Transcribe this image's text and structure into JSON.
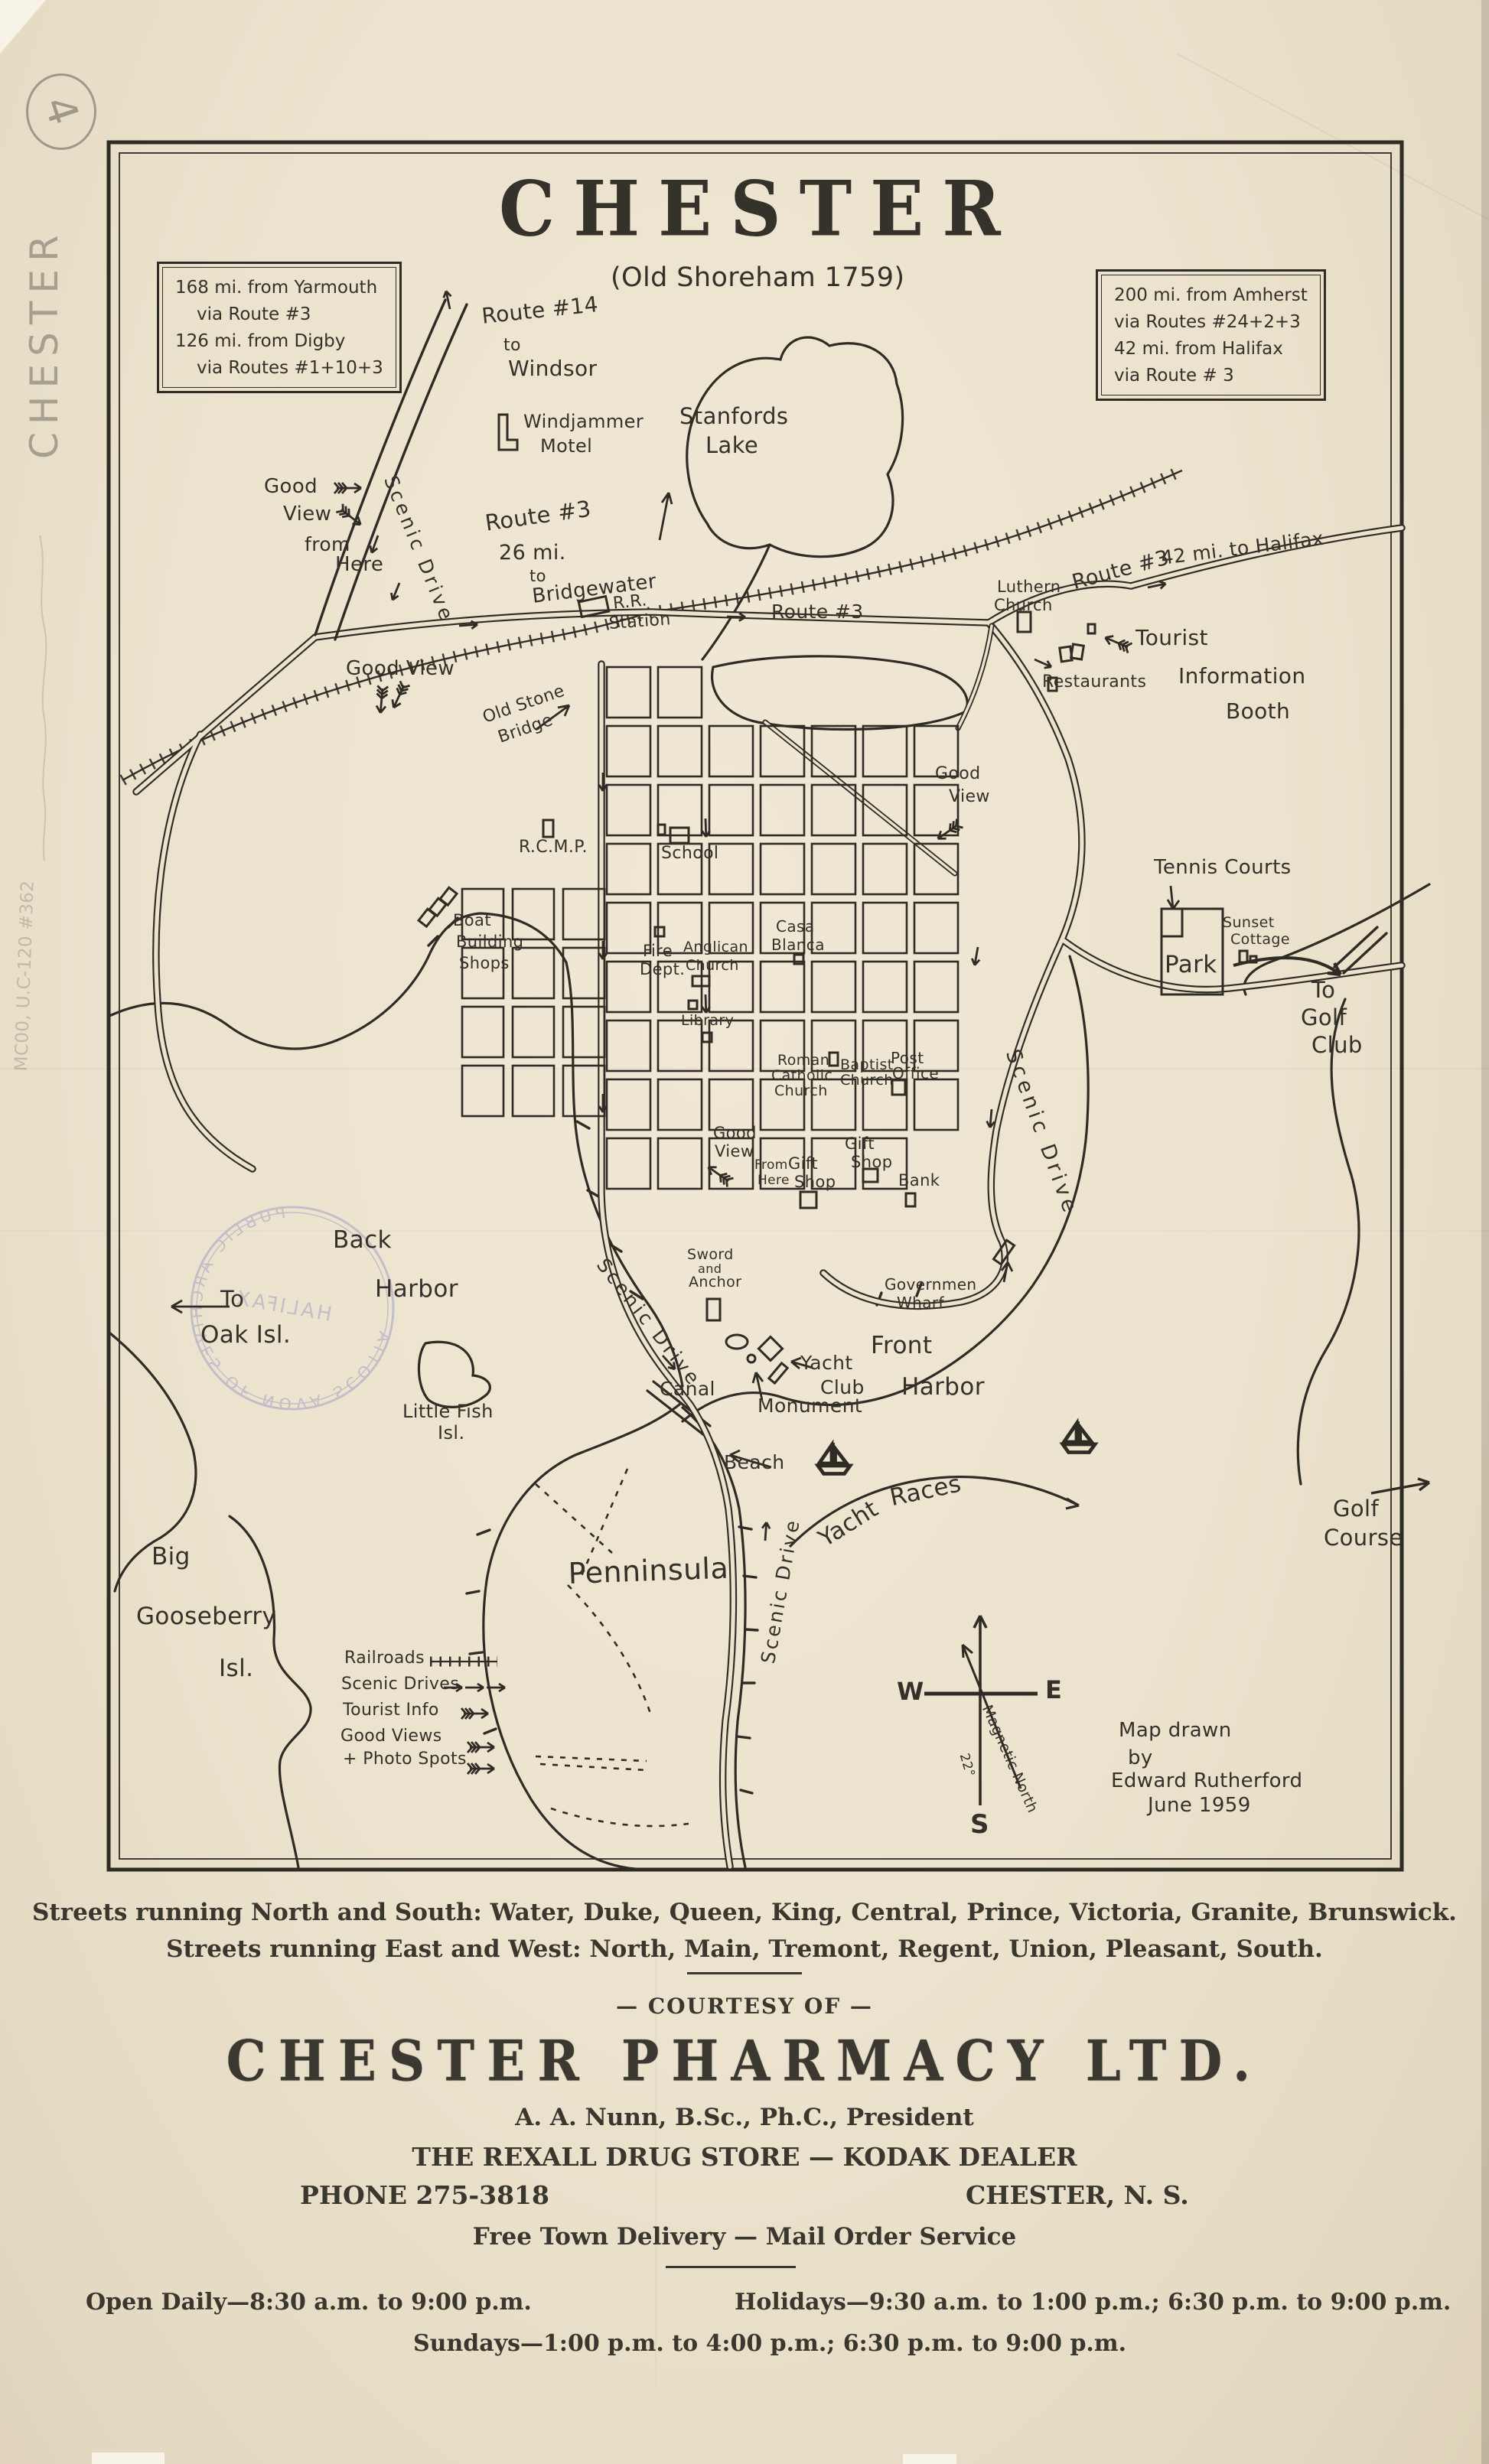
{
  "annotations": {
    "circled_number": "4",
    "margin_note": "CHESTER",
    "catalog_note": "MC00, U.C-120 #362"
  },
  "map": {
    "title": "CHESTER",
    "subtitle": "(Old Shoreham 1759)",
    "box_nw": [
      "168 mi. from Yarmouth",
      "via Route #3",
      "126 mi. from Digby",
      "via Routes #1+10+3"
    ],
    "box_ne": [
      "200 mi. from Amherst",
      "via Routes #24+2+3",
      "42 mi. from Halifax",
      "via Route # 3"
    ],
    "labels": {
      "route14": [
        "Route #14",
        "to",
        "Windsor"
      ],
      "windjammer": [
        "Windjammer",
        "Motel"
      ],
      "stanfords_lake": [
        "Stanfords",
        "Lake"
      ],
      "good_view_nw": [
        "Good",
        "View",
        "from",
        "Here"
      ],
      "scenic_drive_nw": "Scenic Drive",
      "route3_bridgewater": [
        "Route #3",
        "26 mi.",
        "to",
        "Bridgewater"
      ],
      "rr_station": [
        "R.R.",
        "Station"
      ],
      "route3_mid": "Route #3",
      "good_view_w": "Good View",
      "old_stone_bridge": [
        "Old Stone",
        "Bridge"
      ],
      "luthern_church": [
        "Luthern",
        "Church"
      ],
      "route3_halifax_a": "Route #3",
      "route3_halifax_b": "42 mi. to Halifax",
      "tourist_booth": [
        "Tourist",
        "Information",
        "Booth"
      ],
      "restaurants": "Restaurants",
      "good_view_e": [
        "Good",
        "View"
      ],
      "rcmp": "R.C.M.P.",
      "school": "School",
      "tennis_courts": "Tennis Courts",
      "sunset_cottage": [
        "Sunset",
        "Cottage"
      ],
      "park": "Park",
      "to_golf_club": [
        "To",
        "Golf",
        "Club"
      ],
      "boat_building": [
        "Boat",
        "Building",
        "Shops"
      ],
      "fire_dept": [
        "Fire",
        "Dept."
      ],
      "anglican_church": [
        "Anglican",
        "Church"
      ],
      "casa_blanca": [
        "Casa",
        "Blanca"
      ],
      "library": "Library",
      "roman_catholic": [
        "Roman",
        "Catholic",
        "Church"
      ],
      "baptist_church": [
        "Baptist",
        "Church"
      ],
      "post_office": [
        "Post",
        "Office"
      ],
      "good_view_town": [
        "Good",
        "View",
        "From",
        "Here"
      ],
      "gift_shop_w": [
        "Gift",
        "Shop"
      ],
      "gift_shop_e": [
        "Gift",
        "Shop"
      ],
      "bank": "Bank",
      "scenic_drive_e": "Scenic Drive",
      "government_wharf": [
        "Governmen",
        "Wharf"
      ],
      "sword_anchor": [
        "Sword",
        "and",
        "Anchor"
      ],
      "scenic_drive_sw": "Scenic Drive",
      "canal": "Canal",
      "yacht_club": [
        "Yacht",
        "Club"
      ],
      "monument": "Monument",
      "front_harbor": [
        "Front",
        "Harbor"
      ],
      "beach": "Beach",
      "penninsula": "Penninsula",
      "scenic_drive_s": "Scenic Drive",
      "yacht_races": [
        "Yacht",
        "Races"
      ],
      "golf_course": [
        "Golf",
        "Course"
      ],
      "back_harbor": [
        "Back",
        "Harbor"
      ],
      "to_oak_island": [
        "To",
        "Oak Isl."
      ],
      "little_fish_island": [
        "Little Fish",
        "Isl."
      ],
      "big_gooseberry_island": [
        "Big",
        "Gooseberry",
        "Isl."
      ]
    },
    "legend": {
      "railroads": "Railroads",
      "scenic_drives": "Scenic Drives",
      "tourist_info": "Tourist Info",
      "good_views": "Good Views",
      "photo_spots": "+ Photo Spots"
    },
    "compass": {
      "west": "W",
      "east": "E",
      "south": "S",
      "magnetic": "Magnetic North",
      "declination": "22°"
    },
    "credit": [
      "Map drawn",
      "by",
      "Edward Rutherford",
      "June 1959"
    ],
    "stamp": {
      "ring": "PUBLIC  ARCHIVES  OF  NOVA  SCOTIA",
      "center": "HALIFAX"
    }
  },
  "footer": {
    "streets_ns": "Streets running North and South: Water, Duke, Queen, King, Central, Prince, Victoria, Granite, Brunswick.",
    "streets_ew": "Streets running East and West: North, Main, Tremont, Regent, Union, Pleasant, South.",
    "courtesy": "— COURTESY OF —",
    "pharmacy": "CHESTER PHARMACY LTD.",
    "president": "A. A. Nunn, B.Sc., Ph.C., President",
    "store": "THE REXALL DRUG STORE — KODAK DEALER",
    "phone": "PHONE 275-3818",
    "city": "CHESTER, N. S.",
    "delivery": "Free Town Delivery — Mail Order Service",
    "hours_daily": "Open Daily—8:30 a.m. to 9:00 p.m.",
    "hours_holidays": "Holidays—9:30 a.m. to 1:00 p.m.; 6:30 p.m. to 9:00 p.m.",
    "hours_sundays": "Sundays—1:00 p.m. to 4:00 p.m.; 6:30 p.m. to 9:00 p.m."
  },
  "colors": {
    "paper": "#ece3ce",
    "ink": "#2f2c26",
    "pencil": "#8e887a",
    "stamp": "#8084bc"
  }
}
